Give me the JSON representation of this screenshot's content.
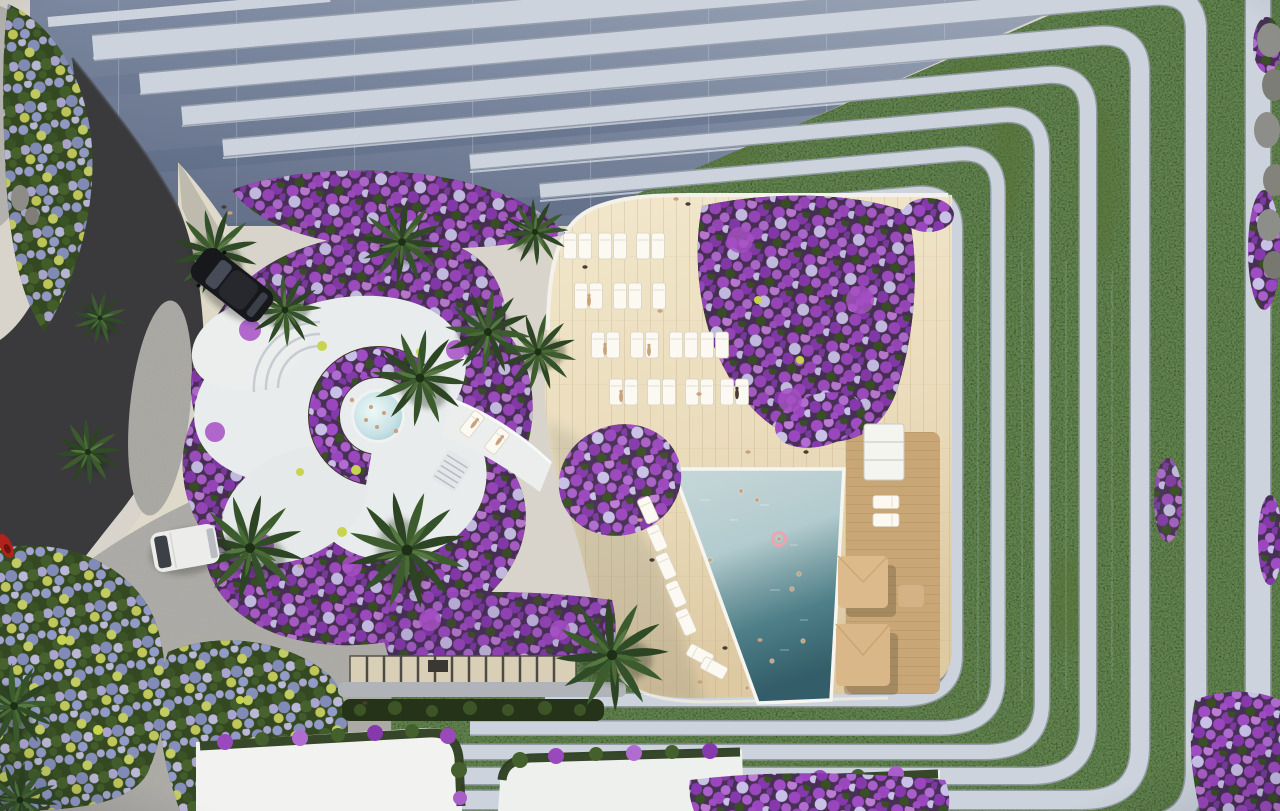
{
  "scene": {
    "setting": "Aerial rendering of a luxury condominium tower amenity deck with pool, spa pavilion, cascading planted terraces and bougainvillea gardens",
    "labels": {
      "facade": "glass balcony facade of tower",
      "terraces": "cascading terrace railings with hedge planters",
      "hedges": "dark green hedge planters",
      "road": "asphalt road",
      "driveway": "beige entry driveway",
      "paths": "stone pathways",
      "gardens": "bougainvillea flower gardens",
      "spa": "white spa pavilion with round plunge pool",
      "plunge_pool": "circular plunge pool",
      "bridge": "white walkway bridge with loungers",
      "deck": "wooden pool deck",
      "pool": "swimming pool",
      "cabanas": "tan poolside cabanas",
      "loungers": "white sun loungers",
      "towel_station": "white towel cabinet",
      "palms": "palm trees",
      "skylight": "slatted pergola skylight",
      "roofs": "white amenity rooftops with flower borders",
      "suv": "black SUV on driveway",
      "van": "white van on path",
      "scooter": "red scooter at road edge",
      "swimmers": "swimmers in pool",
      "people": "sunbathers and pedestrians",
      "rocks": "boulder edge wall"
    },
    "counts": {
      "balcony_bands_visible": 8,
      "terrace_frames": 7,
      "deck_loungers": 27,
      "poolside_loungers": 7,
      "wood_strip_loungers": 4,
      "bridge_loungers": 2,
      "cabanas": 2,
      "palm_trees": 14,
      "swimmers": 9,
      "plunge_pool_bathers": 6,
      "people_on_deck_and_paths": 24,
      "vehicles": 3
    },
    "palette": {
      "glassDark": "#64718a",
      "glassLight": "#9aa5b6",
      "rail": "#ccd3dd",
      "railShadow": "#98a1ad",
      "hedge": "#1f2d17",
      "hedgeLight": "#567239",
      "road": "#3a3a3c",
      "stone": "#a7a5a0",
      "stoneLight": "#b3b1ac",
      "sand": "#ded9c9",
      "wood": "#ecdfc2",
      "woodDark": "#c9a675",
      "poolShallow": "#c2d4d6",
      "poolDeep": "#3f6f7a",
      "jacuzzi": "#cfe4e6",
      "white": "#eff1f0",
      "bloomPurple": "#9a46be",
      "bloomLavender": "#b7aede",
      "bloomYellow": "#ccd55e",
      "leafGreen": "#44602c",
      "canvasTan": "#d9b789",
      "skin": "#c9a27b",
      "red": "#b0231c"
    }
  }
}
